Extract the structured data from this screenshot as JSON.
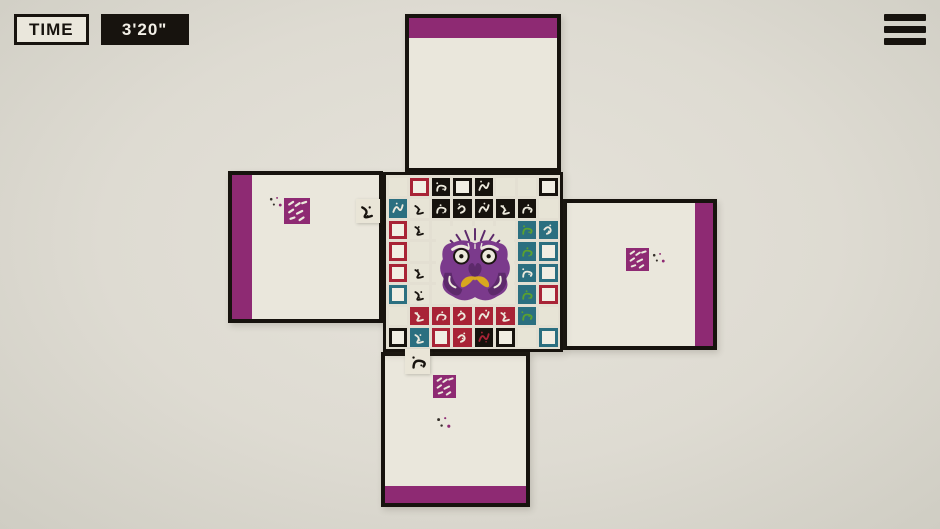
{
  "hud": {
    "time_label": "TIME",
    "time_value": "3'20\""
  },
  "menu": {
    "icon": "hamburger-icon"
  },
  "colors": {
    "background": "#dedbd2",
    "panel": "#eae7dc",
    "border_black": "#17130e",
    "purple": "#8e2a73",
    "red": "#a82336",
    "teal": "#2b6f80",
    "green": "#5aa12f",
    "cream_tile": "#e7e4d6",
    "tile_white": "#f1eee3",
    "black_tile": "#16120d",
    "icon_cream": "#ece9dc",
    "face_purple": "#7b3a8c",
    "face_dark": "#5d2a6b",
    "face_gold": "#d8a81f"
  },
  "board": {
    "grid": {
      "rows": 8,
      "cols": 8,
      "legend": {
        "C": "empty-cream",
        "RB": "red-border-slot",
        "KB": "black-border-slot",
        "TB": "teal-border-slot",
        "KI": "black-pictogram",
        "CI": "cream-pictogram",
        "TI": "teal-pictogram",
        "TG": "teal-green-pictogram",
        "RI": "red-pictogram",
        "KR": "black-red-pictogram",
        "F": "creature-face-area"
      },
      "cells": [
        [
          "C",
          "RB",
          "KI",
          "KB",
          "KI",
          "C",
          "C",
          "KB"
        ],
        [
          "TI",
          "CI",
          "KI",
          "KI",
          "KI",
          "KI",
          "KI",
          "C"
        ],
        [
          "RB",
          "CI",
          "F",
          "F",
          "F",
          "F",
          "TG",
          "TI"
        ],
        [
          "RB",
          "C",
          "F",
          "F",
          "F",
          "F",
          "TG",
          "TB"
        ],
        [
          "RB",
          "CI",
          "F",
          "F",
          "F",
          "F",
          "TI",
          "TB"
        ],
        [
          "TB",
          "CI",
          "F",
          "F",
          "F",
          "F",
          "TG",
          "RB"
        ],
        [
          "C",
          "RI",
          "RI",
          "RI",
          "RI",
          "RI",
          "TG",
          "C"
        ],
        [
          "KB",
          "TI",
          "RB",
          "RI",
          "KR",
          "KB",
          "C",
          "TB"
        ]
      ],
      "center_art": "purple-bulldog-face"
    },
    "arms": [
      {
        "id": "top",
        "x": 405,
        "y": 14,
        "w": 156,
        "h": 158,
        "bar": "top",
        "decor": []
      },
      {
        "id": "left",
        "x": 228,
        "y": 171,
        "w": 155,
        "h": 152,
        "bar": "left",
        "decor": [
          {
            "type": "dots",
            "x": 268,
            "y": 196,
            "s": 16
          },
          {
            "type": "stamp",
            "x": 284,
            "y": 198,
            "s": 26
          },
          {
            "type": "tile",
            "x": 356,
            "y": 199,
            "s": 24,
            "seed": 5
          }
        ]
      },
      {
        "id": "right",
        "x": 563,
        "y": 199,
        "w": 154,
        "h": 151,
        "bar": "right",
        "decor": [
          {
            "type": "stamp",
            "x": 626,
            "y": 248,
            "s": 23
          },
          {
            "type": "dots",
            "x": 651,
            "y": 252,
            "s": 16
          }
        ]
      },
      {
        "id": "bottom",
        "x": 381,
        "y": 352,
        "w": 149,
        "h": 155,
        "bar": "bottom",
        "decor": [
          {
            "type": "tile",
            "x": 405,
            "y": 349,
            "s": 25,
            "seed": 2
          },
          {
            "type": "stamp",
            "x": 433,
            "y": 375,
            "s": 23
          },
          {
            "type": "dots",
            "x": 435,
            "y": 416,
            "s": 18
          }
        ]
      }
    ]
  }
}
